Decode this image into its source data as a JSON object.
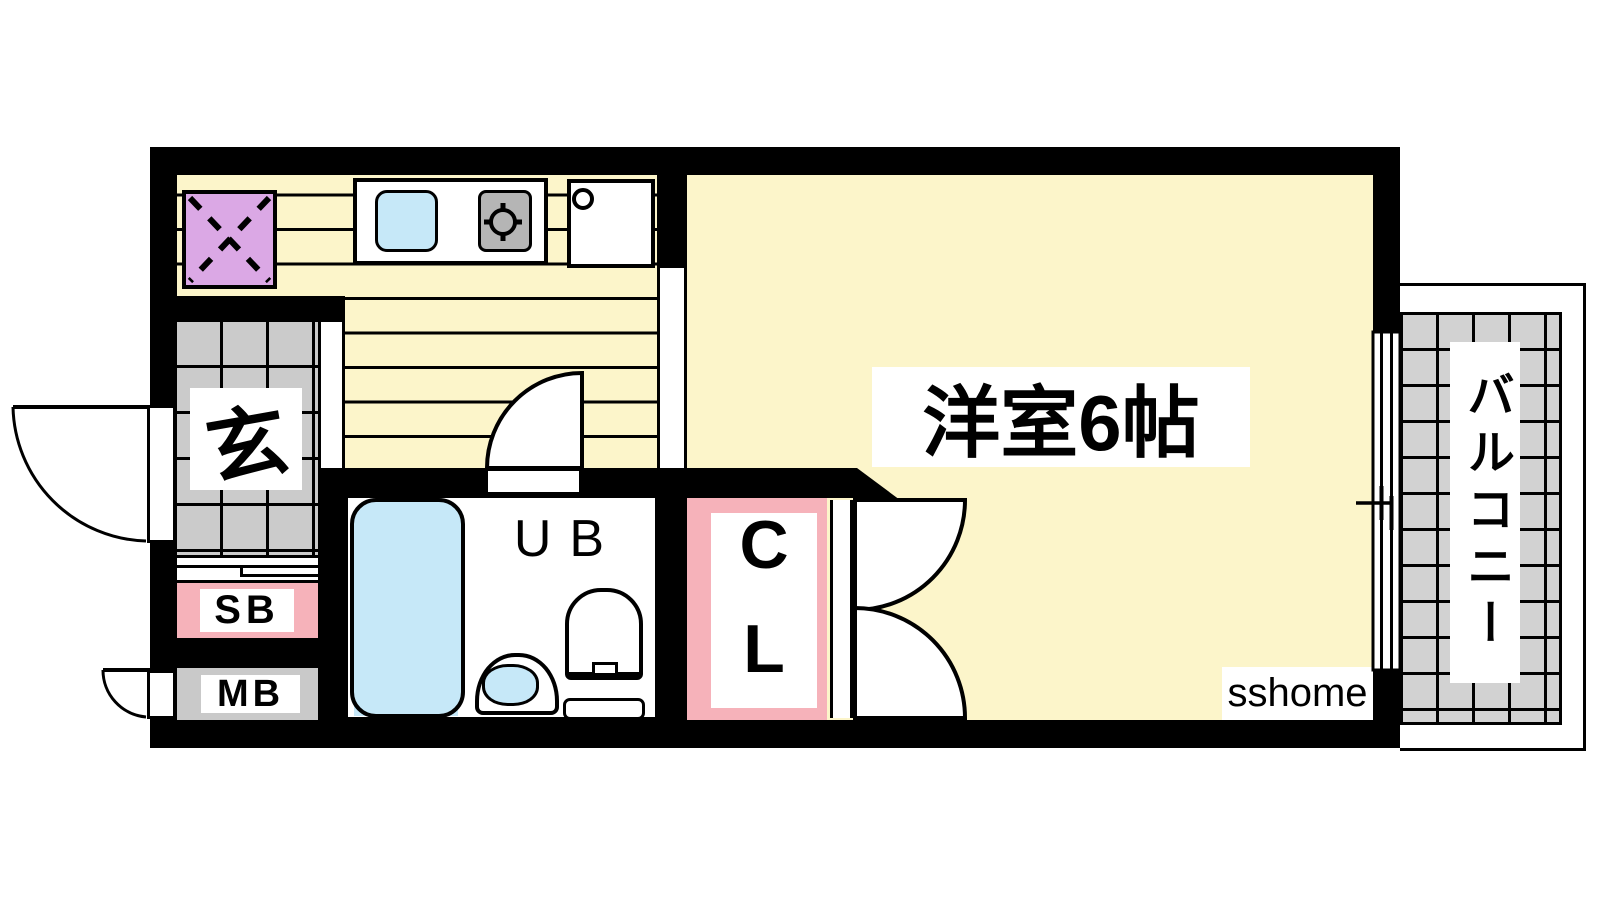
{
  "watermark": {
    "text": "sshome"
  },
  "rooms": {
    "western_room": {
      "label": "洋室6帖"
    },
    "entrance": {
      "label": "玄"
    },
    "shoe_box": {
      "label": "SB"
    },
    "meter_box": {
      "label": "MB"
    },
    "unit_bath": {
      "label": "UB"
    },
    "closet": {
      "label": "CL"
    },
    "balcony": {
      "label": "バルコニー"
    }
  },
  "colors": {
    "wall": "#000000",
    "floor_yellow": "#FCF5CA",
    "tile_gray": "#CBCBCB",
    "balcony_gray": "#D2D2D2",
    "fixture_blue": "#C6E8F8",
    "fridge_purple": "#DBA8E5",
    "accent_pink": "#F6B2BA",
    "stove_gray": "#B5B5B5",
    "meter_gray": "#C9C9C9",
    "label_text": "#000000"
  }
}
